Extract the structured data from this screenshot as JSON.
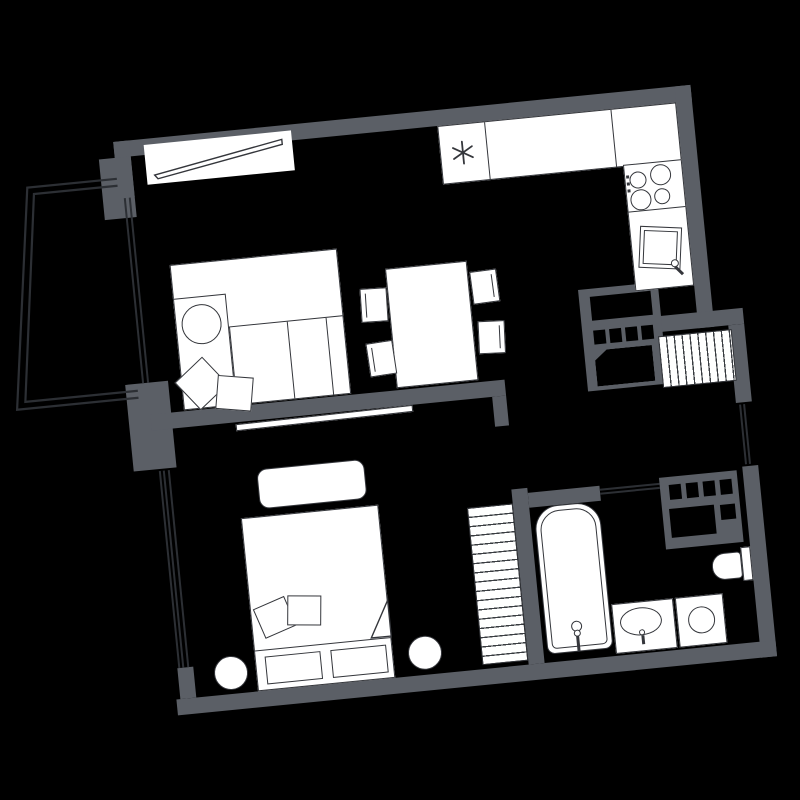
{
  "meta": {
    "title": "Apartment floor plan",
    "type": "architectural-floor-plan",
    "style": "white furniture line-work on black background with gray walls, plan rotated slightly counter-clockwise"
  },
  "colors": {
    "background": "#000000",
    "wall": "#5b5f66",
    "furniture_fill": "#ffffff",
    "furniture_stroke": "#34363b",
    "glazing_line": "#2c2f34",
    "hatch_line": "#3a3d42"
  },
  "rotation_deg": -5.65,
  "rooms": [
    {
      "name": "living-room",
      "furniture": [
        "window-with-sill",
        "corner-sofa",
        "round-cushion",
        "two-throw-pillows",
        "dining-table",
        "four-chairs",
        "balcony-door"
      ]
    },
    {
      "name": "kitchen",
      "furniture": [
        "fridge-with-snowflake",
        "straight-counter",
        "corner-counter",
        "stove-four-burners",
        "tilted-sink-with-faucet"
      ]
    },
    {
      "name": "hallway",
      "furniture": [
        "hatched-wardrobe",
        "utility-shaft",
        "entry-door"
      ]
    },
    {
      "name": "bedroom",
      "furniture": [
        "double-bed",
        "two-pillows",
        "blanket-fold",
        "two-foot-drawers",
        "two-round-stools",
        "bench-rug",
        "hatched-wardrobe",
        "window",
        "sliding-door-leaf"
      ]
    },
    {
      "name": "bathroom",
      "furniture": [
        "bathtub-with-drain-and-faucet",
        "vanity-with-oval-sink",
        "washing-machine",
        "toilet-with-tank",
        "utility-shaft",
        "door"
      ]
    },
    {
      "name": "balcony",
      "furniture": [
        "double-outline"
      ]
    }
  ],
  "counts": {
    "stove_burners": 4,
    "dining_chairs": 4,
    "bed_pillows": 2,
    "sofa_throw_pillows": 2,
    "round_stools": 2,
    "shaft_vents_top": 4,
    "shaft_vents_bath": 4
  }
}
